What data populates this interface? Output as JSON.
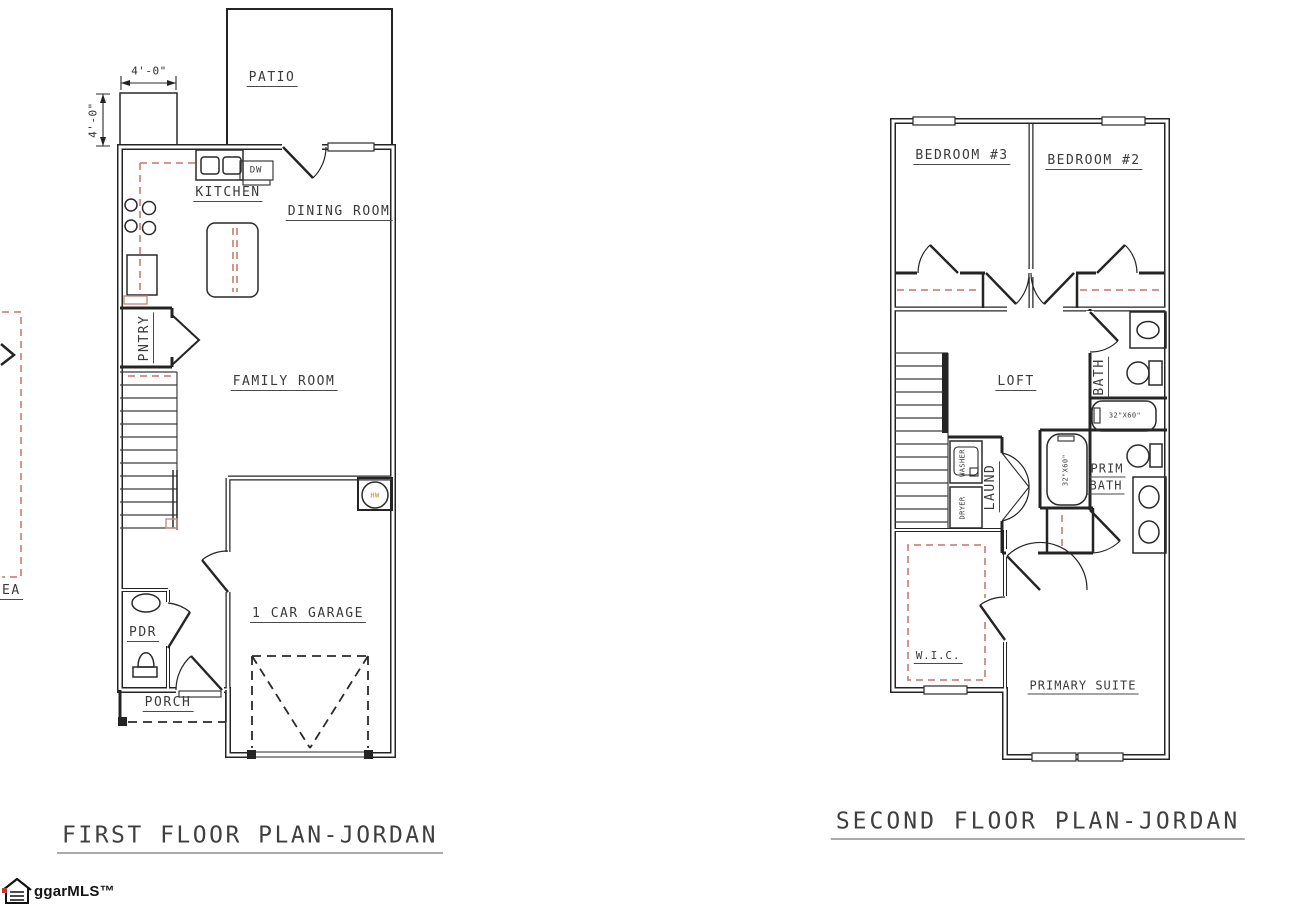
{
  "first_floor": {
    "title": "FIRST FLOOR PLAN-JORDAN",
    "rooms": {
      "patio": "PATIO",
      "kitchen": "KITCHEN",
      "dining_room": "DINING ROOM",
      "pantry": "PNTRY",
      "family_room": "FAMILY ROOM",
      "powder_room": "PDR",
      "porch": "PORCH",
      "garage": "1 CAR GARAGE"
    },
    "fixtures": {
      "dishwasher": "DW",
      "water_heater": "HW"
    },
    "dimensions": {
      "width": "4'-0\"",
      "depth": "4'-0\""
    }
  },
  "second_floor": {
    "title": "SECOND FLOOR PLAN-JORDAN",
    "rooms": {
      "bedroom3": "BEDROOM #3",
      "bedroom2": "BEDROOM #2",
      "loft": "LOFT",
      "bath": "BATH",
      "laundry": "LAUND",
      "prim_bath_line1": "PRIM",
      "prim_bath_line2": "BATH",
      "wic": "W.I.C.",
      "primary_suite": "PRIMARY SUITE"
    },
    "fixtures": {
      "washer": "WASHER",
      "dryer": "DRYER",
      "hall_tub_size": "32\"X60\"",
      "primary_tub_size": "32\"X60\""
    }
  },
  "edge_partial": {
    "label": "EA"
  },
  "watermark": {
    "brand": "ggarMLS™"
  },
  "colors": {
    "line": "#242424",
    "dashed_red": "#cc8a80",
    "hw_text": "#b3912c"
  }
}
